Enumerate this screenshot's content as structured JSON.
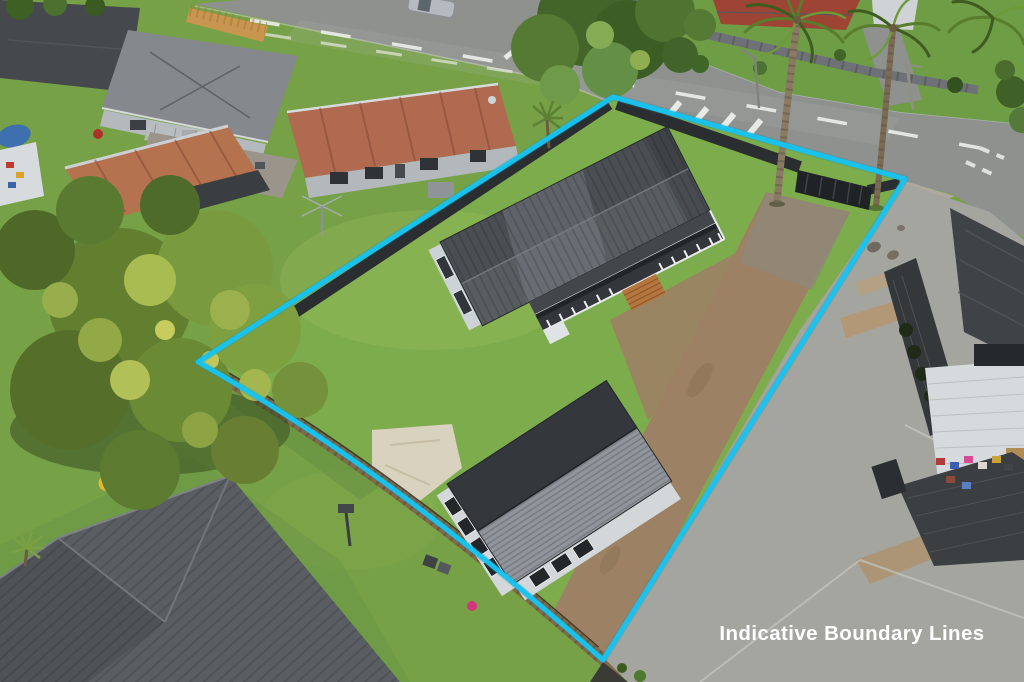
{
  "image": {
    "description": "Aerial drone photograph of a residential section with two buildings, lawns, a dirt driveway and an overlaid indicative boundary outline",
    "width": 1024,
    "height": 682
  },
  "caption": {
    "text": "Indicative Boundary Lines"
  },
  "boundary": {
    "path": "M613,97 L905,179 L603,660 Q390,470 198,362 Z",
    "color": "#17c3ef",
    "glow_color": "#0b8fb8",
    "stroke_width": 5
  },
  "palette": {
    "grass_base": "#76a147",
    "lawn_subject": "#7dac4d",
    "verge": "#6f9d45",
    "road": "#8e918e",
    "road_marking": "#eceeea",
    "dirt_driveway": "#9c8164",
    "sand_patch": "#d9d2bf",
    "concrete": "#a4a59f",
    "tan_strip": "#b29877",
    "main_roof_north": "#4b4f54",
    "main_roof_south": "#585d62",
    "house_wall": "#cdd2d6",
    "veranda_deck": "#33363a",
    "railing": "#e8eaec",
    "wood_steps": "#b5753e",
    "b2_roof_dark": "#34373b",
    "b2_roof_light": "#90959b",
    "b2_wall": "#d3d7da",
    "red_house_roof": "#b06a4f",
    "red_tile_roof": "#9e4434",
    "rusty_shed_roof": "#b5724f",
    "gray_house_roof": "#85888c",
    "dark_house_roof": "#45484c",
    "sw_roof": "#5a5e63",
    "right_house_roof": "#3f4347",
    "right_house_wall": "#d7dadc",
    "fence_dark": "#2b2e31",
    "fence_wood": "#826a49",
    "tree_dark": "#3b5a20",
    "tree_mid": "#618433",
    "tree_light": "#95b147",
    "palm_trunk": "#8a7a63",
    "tarp_blue": "#3e6fae",
    "tarp_yellow": "#e6b82e",
    "pink_toy": "#d6347f",
    "caption_color": "#ffffff"
  }
}
